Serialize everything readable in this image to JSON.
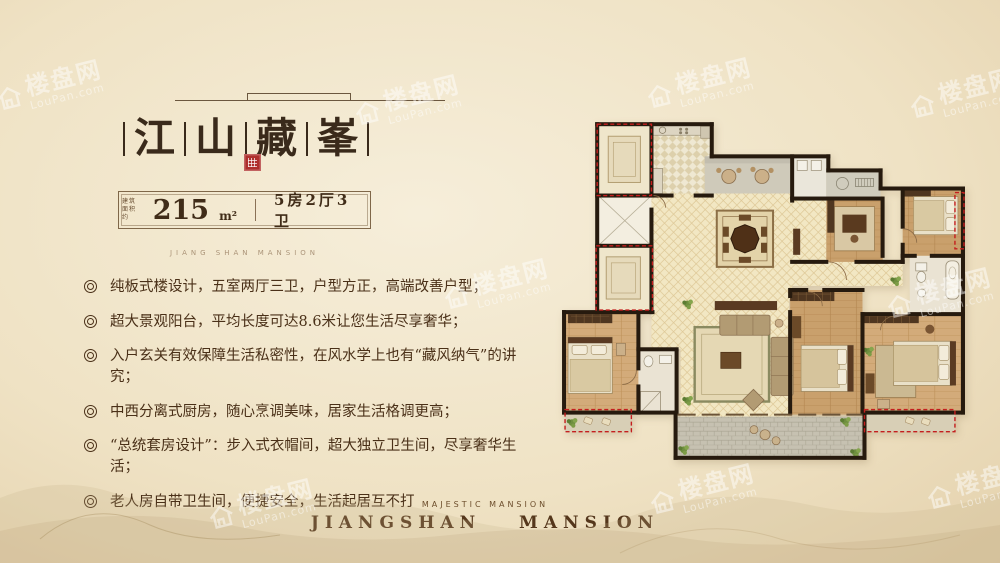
{
  "watermark": {
    "brand": "楼盘网",
    "domain": "LouPan.com"
  },
  "left_panel": {
    "title_chars": [
      "江",
      "山",
      "藏",
      "峯"
    ],
    "area": {
      "label_line1": "建筑",
      "label_line2": "面积约",
      "value": "215",
      "unit": "m²",
      "layout": "5房2厅3卫"
    },
    "subtitle_en": "JIANG SHAN MANSION",
    "features": [
      "纯板式楼设计，五室两厅三卫，户型方正，高端改善户型；",
      "超大景观阳台，平均长度可达8.6米让您生活尽享奢华；",
      "入户玄关有效保障生活私密性，在风水学上也有“藏风纳气”的讲究；",
      "中西分离式厨房，随心烹调美味，居家生活格调更高；",
      "“总统套房设计”：步入式衣帽间，超大独立卫生间，尽享奢华生活；",
      "老人房自带卫生间，便捷安全，生活起居互不打"
    ]
  },
  "footer": {
    "tagline_en": "MAJESTIC MANSION",
    "brand_en": "JIANGSHAN MANSION"
  },
  "colors": {
    "seal-red": "#ae2f2d",
    "red-dash": "#c41e1e",
    "wall": "#261a0e",
    "floor-cream": "#f2e7c3",
    "floor-wood": "#c9a06c",
    "tile-gray": "#c6c1b1",
    "ink": "#3a2a1b"
  }
}
